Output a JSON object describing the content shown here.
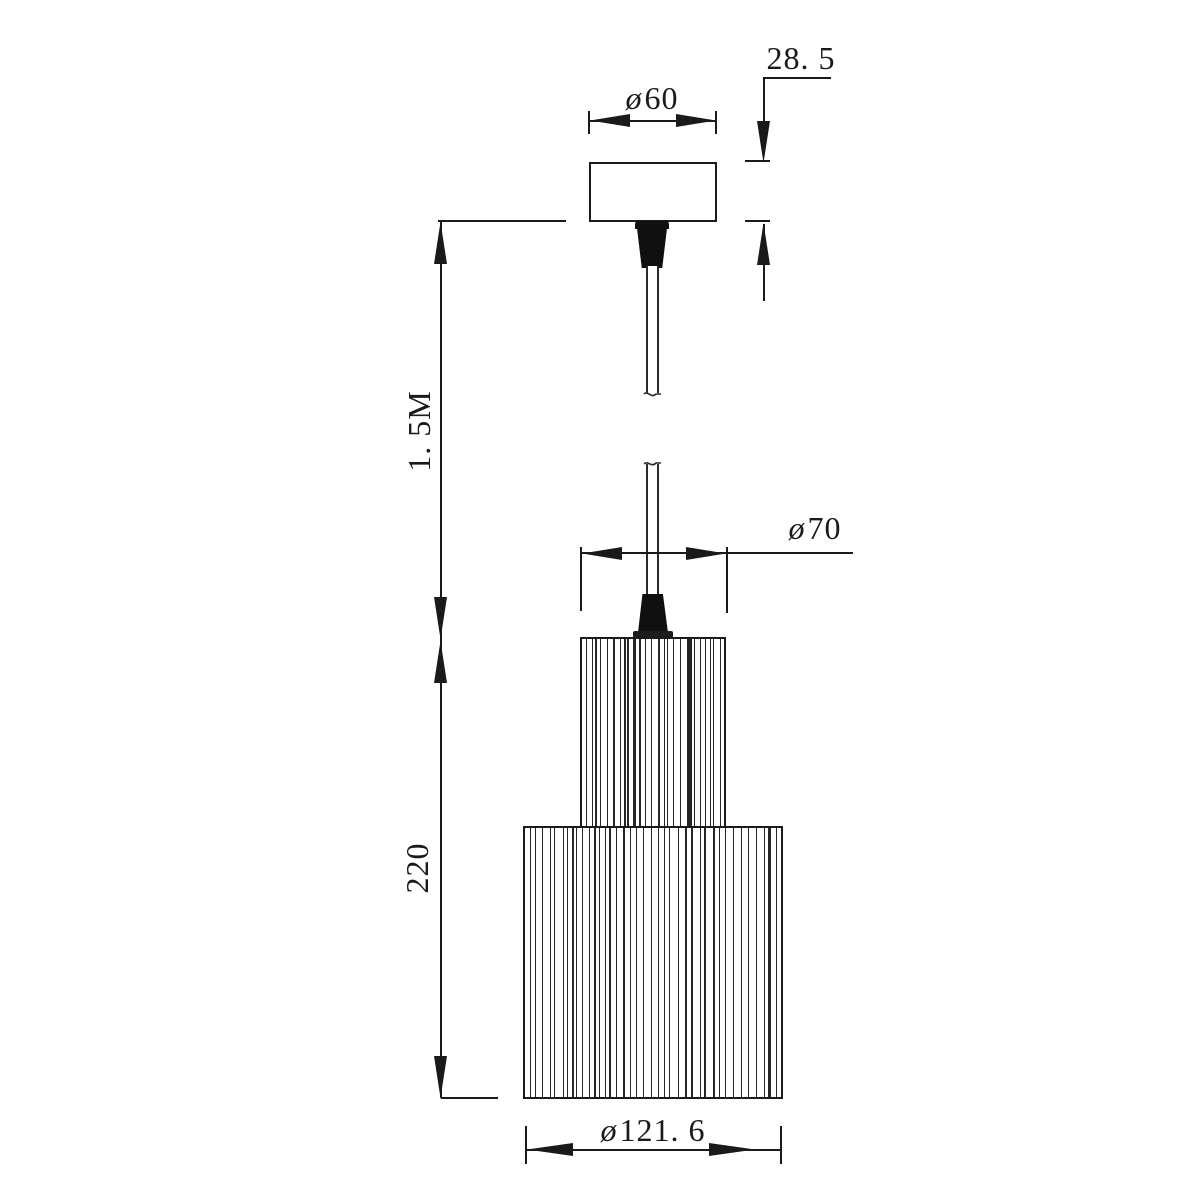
{
  "drawing": {
    "kind": "pendant-lamp dimension drawing",
    "labels": {
      "canopy_diameter": {
        "symbol": "ø",
        "value": "60"
      },
      "canopy_height": {
        "value": "28. 5"
      },
      "cord_length": {
        "value": "1. 5M"
      },
      "shade_top_diameter": {
        "symbol": "ø",
        "value": "70"
      },
      "shade_height": {
        "value": "220"
      },
      "shade_bottom_diameter": {
        "symbol": "ø",
        "value": "121. 6"
      }
    },
    "colors": {
      "line": "#1a1a1a",
      "fill_black": "#101010",
      "background": "#ffffff"
    }
  }
}
